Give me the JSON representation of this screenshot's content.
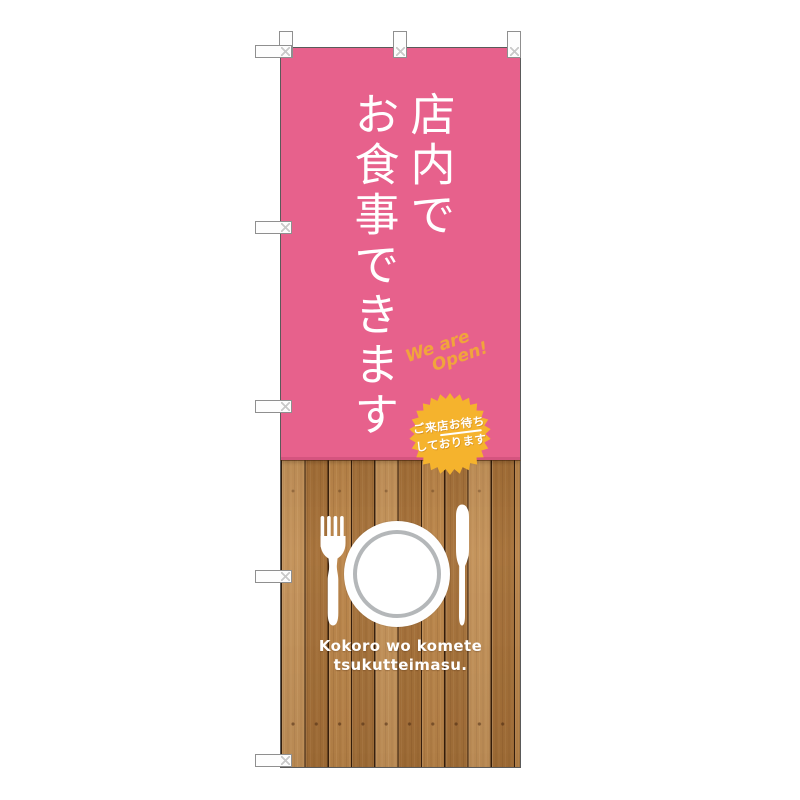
{
  "banner": {
    "colors": {
      "pink": "#e7618c",
      "badge_yellow": "#f5b32d",
      "open_text_orange": "#f1a43c",
      "wood_base": "#b67e41",
      "text_white": "#ffffff",
      "plate_ring_gray": "#b4b7b9"
    },
    "title": {
      "full_text": "店内でお食事できます",
      "column_right": "店内で",
      "column_left": "お食事できます"
    },
    "open_note": {
      "line1": "We are",
      "line2": "Open!"
    },
    "badge": {
      "line1": "ご来店お待ち",
      "line2": "しております"
    },
    "tagline": {
      "line1": "Kokoro wo komete",
      "line2": "tsukutteimasu."
    }
  }
}
